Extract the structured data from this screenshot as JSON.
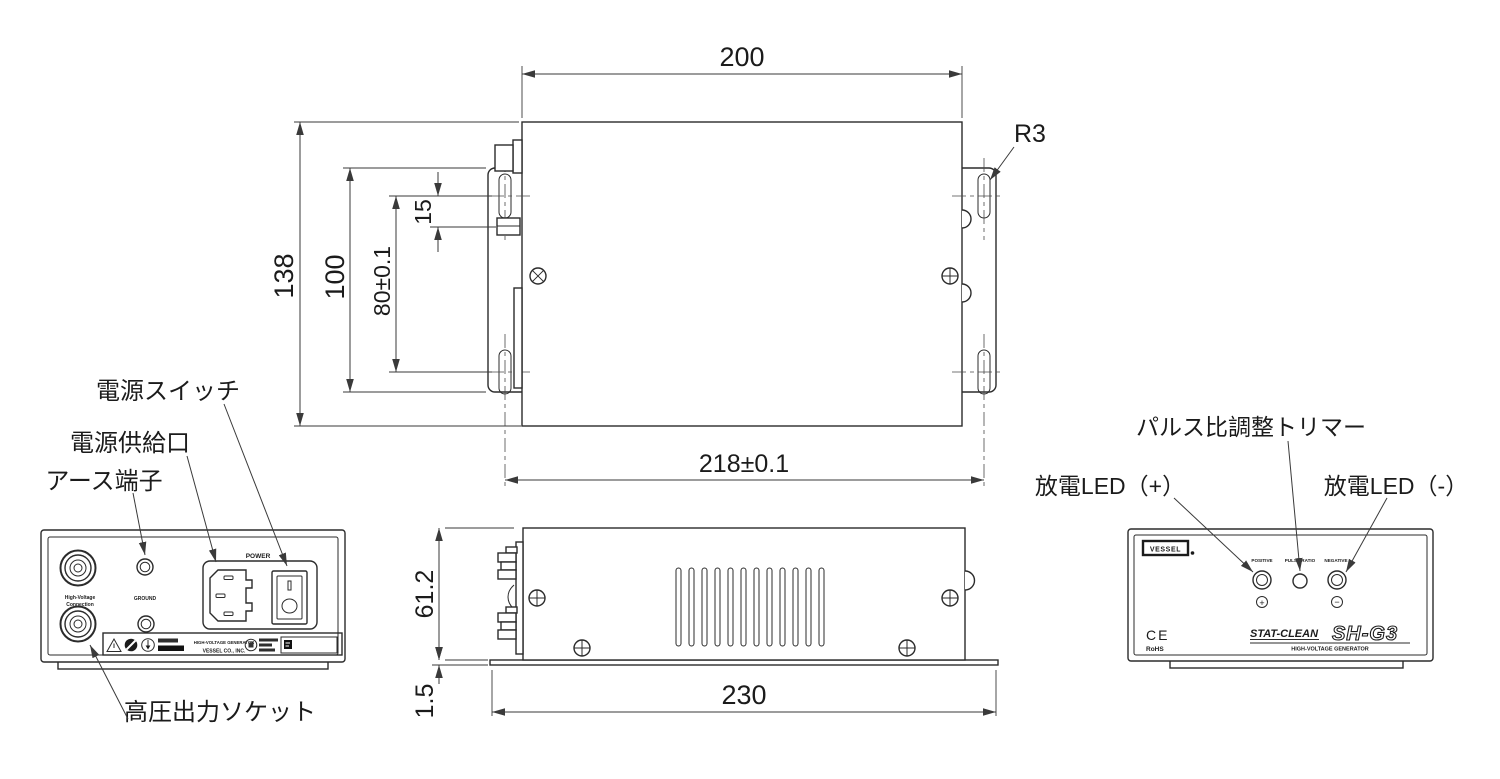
{
  "top": {
    "width": "200",
    "overall_height": "138",
    "flange_height": "100",
    "slot_pitch": "80±0.1",
    "slot_offset": "15",
    "corner_radius": "R3",
    "mount_pitch": "218±0.1"
  },
  "side": {
    "height": "61.2",
    "plate_thickness": "1.5",
    "base_length": "230"
  },
  "rear": {
    "callout_power_switch": "電源スイッチ",
    "callout_power_inlet": "電源供給口",
    "callout_ground_terminal": "アース端子",
    "callout_hv_socket": "高圧出力ソケット",
    "hv_label_1": "High-Voltage",
    "hv_label_2": "Connection",
    "ground_label": "GROUND",
    "power_label": "POWER",
    "rating_product": "HIGH-VOLTAGE GENERATOR",
    "rating_company": "VESSEL CO., INC."
  },
  "front": {
    "callout_trimmer": "パルス比調整トリマー",
    "callout_led_positive": "放電LED（+）",
    "callout_led_negative": "放電LED（-）",
    "brand": "VESSEL",
    "label_positive": "POSITIVE",
    "label_pulse_ratio": "PULSE RATIO",
    "label_negative": "NEGATIVE",
    "mark_plus": "+",
    "mark_minus": "−",
    "ce_mark": "CE",
    "rohs": "RoHS",
    "logo_series": "STAT-CLEAN",
    "logo_model": "SH-G3",
    "logo_subtitle": "HIGH-VOLTAGE GENERATOR"
  }
}
